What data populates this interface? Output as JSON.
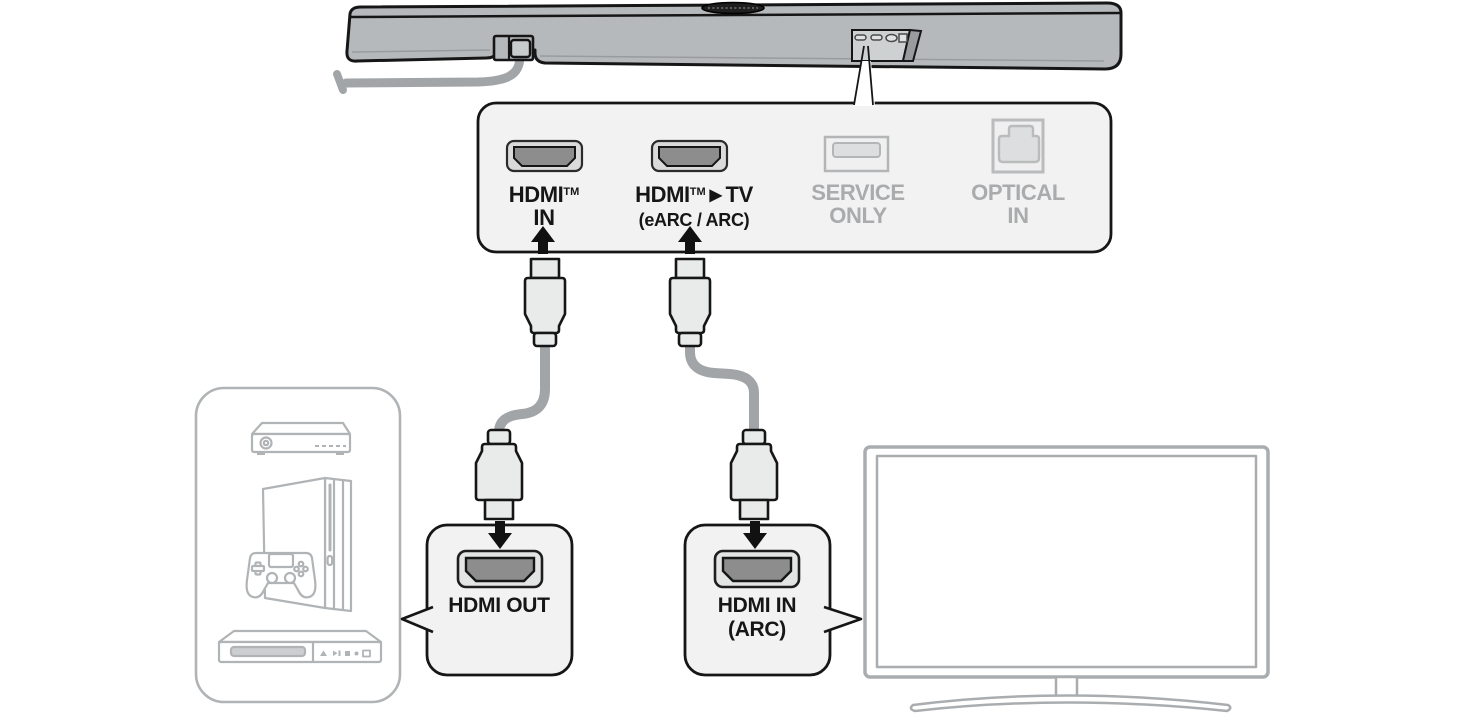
{
  "panel": {
    "hdmi_in": {
      "brand": "HDMI",
      "tm": "TM",
      "line2": "IN"
    },
    "hdmi_tv": {
      "brand": "HDMI",
      "tm": "TM",
      "pointer": "▶",
      "target": "TV",
      "line2": "(eARC / ARC)"
    },
    "service": {
      "line1": "SERVICE",
      "line2": "ONLY"
    },
    "optical": {
      "line1": "OPTICAL",
      "line2": "IN"
    }
  },
  "callouts": {
    "hdmi_out": {
      "label": "HDMI OUT"
    },
    "hdmi_in_arc": {
      "line1": "HDMI IN",
      "line2": "(ARC)"
    }
  },
  "icons": {
    "soundbar": "soundbar-illustration",
    "power_cable": "power-cable-icon",
    "hdmi_port": "hdmi-port-icon",
    "usb_port": "usb-port-icon",
    "optical_port": "optical-port-icon",
    "up_arrow": "up-arrow-icon",
    "down_arrow": "down-arrow-icon",
    "hdmi_connector": "hdmi-connector-icon",
    "set_top_box": "set-top-box-icon",
    "game_console": "game-console-icon",
    "gamepad": "gamepad-icon",
    "disc_player": "disc-player-icon",
    "tv": "tv-icon"
  },
  "colors": {
    "background": "#ffffff",
    "outline": "#161616",
    "panel_fill": "#f2f2f2",
    "soundbar_gray": "#b6b9bb",
    "recess_gray": "#ced1d2",
    "cable_gray": "#a2a5a7",
    "connector_fill": "#e9eaea",
    "port_inner_gray": "#8d8d8d",
    "muted_outline": "#b1b4b6",
    "tv_outline": "#aaadaf",
    "text_black": "#161616",
    "text_muted": "#a9abad"
  }
}
